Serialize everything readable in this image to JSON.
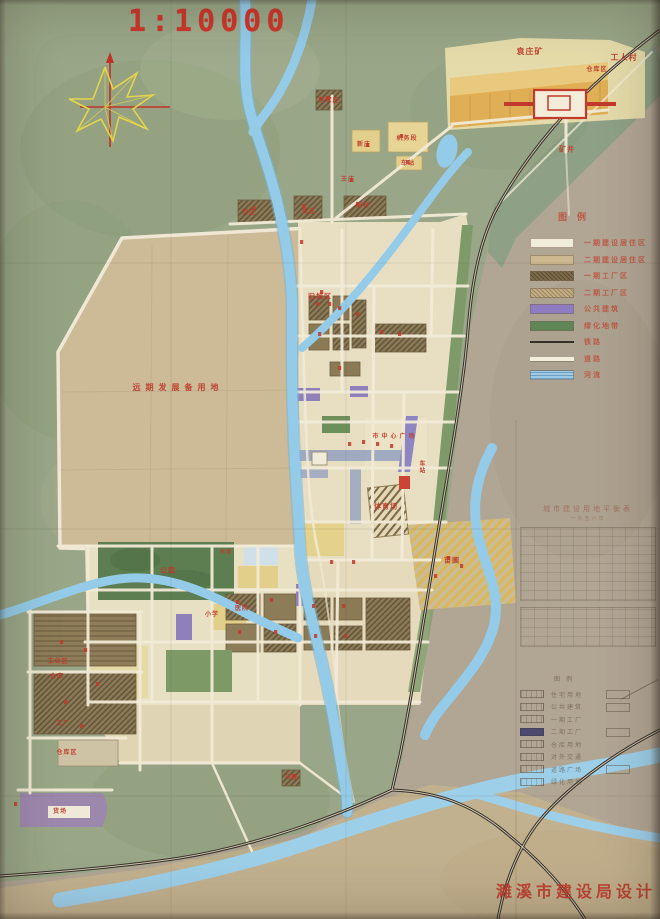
{
  "map": {
    "scale_label": "1:10000",
    "credit": "濉溪市建设局设计",
    "colors": {
      "label_red": "#bf3a2c",
      "scale_red": "#ce352b",
      "river_blue": "#8cc6e6",
      "paper_tan": "#c9b795",
      "paper_grey": "#b1a594",
      "farm_green": "#99a687",
      "block_cream": "#e9e0c4",
      "block_yellow": "#e4d18c",
      "block_brown": "#8d7c58",
      "block_purple": "#8f7fba",
      "park_green": "#5c7e50",
      "rail_black": "#35302a",
      "industrial_orange": "#dfae55"
    },
    "legend": {
      "title": "图例",
      "rows": [
        {
          "label": "一期建设居住区",
          "swatch": "cream"
        },
        {
          "label": "二期建设居住区",
          "swatch": "tan"
        },
        {
          "label": "一期工厂区",
          "swatch": "brown-hatch"
        },
        {
          "label": "二期工厂区",
          "swatch": "tan-hatch"
        },
        {
          "label": "公共建筑",
          "swatch": "purple"
        },
        {
          "label": "绿化地带",
          "swatch": "green"
        },
        {
          "label": "铁路",
          "swatch": "rail-line"
        },
        {
          "label": "道路",
          "swatch": "road"
        },
        {
          "label": "河流",
          "swatch": "river"
        }
      ]
    },
    "pencil_table": {
      "title": "城市建设用地平衡表",
      "subtitle": "一九五六年"
    },
    "pencil_legend": {
      "title": "图例",
      "rows": [
        {
          "label": "住宅用地",
          "filled": false
        },
        {
          "label": "公共建筑",
          "filled": false
        },
        {
          "label": "一期工厂",
          "filled": false
        },
        {
          "label": "二期工厂",
          "filled": true
        },
        {
          "label": "仓库用地",
          "filled": false
        },
        {
          "label": "对外交通",
          "filled": false
        },
        {
          "label": "道路广场",
          "filled": false
        },
        {
          "label": "绿化用地",
          "filled": false
        }
      ],
      "right_rows": [
        0,
        1,
        3,
        6
      ]
    },
    "labels": [
      {
        "text": "袁庄矿",
        "x": 530,
        "y": 52,
        "size": 8
      },
      {
        "text": "工人村",
        "x": 624,
        "y": 58,
        "size": 8
      },
      {
        "text": "仓库区",
        "x": 597,
        "y": 70,
        "size": 6
      },
      {
        "text": "矿井",
        "x": 567,
        "y": 150,
        "size": 7
      },
      {
        "text": "李家庄",
        "x": 329,
        "y": 101,
        "size": 6
      },
      {
        "text": "新庄",
        "x": 364,
        "y": 145,
        "size": 6
      },
      {
        "text": "机务段",
        "x": 407,
        "y": 139,
        "size": 6
      },
      {
        "text": "车站",
        "x": 408,
        "y": 164,
        "size": 6
      },
      {
        "text": "王庄",
        "x": 348,
        "y": 180,
        "size": 6
      },
      {
        "text": "刘庄",
        "x": 249,
        "y": 213,
        "size": 6
      },
      {
        "text": "张庄",
        "x": 309,
        "y": 212,
        "size": 6
      },
      {
        "text": "旧村",
        "x": 363,
        "y": 206,
        "size": 6
      },
      {
        "text": "旧城区",
        "x": 320,
        "y": 297,
        "size": 7
      },
      {
        "text": "远期发展备用地",
        "x": 178,
        "y": 388,
        "size": 8,
        "spacing": 5
      },
      {
        "text": "市中心广场",
        "x": 395,
        "y": 437,
        "size": 6,
        "spacing": 3
      },
      {
        "text": "车站",
        "x": 421,
        "y": 467,
        "size": 6,
        "vertical": true
      },
      {
        "text": "体育场",
        "x": 386,
        "y": 507,
        "size": 7
      },
      {
        "text": "苗圃",
        "x": 452,
        "y": 561,
        "size": 7
      },
      {
        "text": "公园",
        "x": 168,
        "y": 571,
        "size": 7
      },
      {
        "text": "市场",
        "x": 226,
        "y": 553,
        "size": 5
      },
      {
        "text": "小学",
        "x": 212,
        "y": 615,
        "size": 6
      },
      {
        "text": "医院",
        "x": 242,
        "y": 609,
        "size": 6
      },
      {
        "text": "工业区",
        "x": 58,
        "y": 662,
        "size": 6
      },
      {
        "text": "仓库",
        "x": 57,
        "y": 677,
        "size": 6
      },
      {
        "text": "工厂",
        "x": 63,
        "y": 724,
        "size": 6
      },
      {
        "text": "仓库区",
        "x": 67,
        "y": 753,
        "size": 6
      },
      {
        "text": "货场",
        "x": 60,
        "y": 812,
        "size": 6
      },
      {
        "text": "马庄",
        "x": 292,
        "y": 778,
        "size": 6
      }
    ],
    "building_marks": [
      [
        316,
        302
      ],
      [
        328,
        302
      ],
      [
        318,
        332
      ],
      [
        338,
        306
      ],
      [
        356,
        312
      ],
      [
        380,
        330
      ],
      [
        398,
        332
      ],
      [
        338,
        366
      ],
      [
        300,
        240
      ],
      [
        252,
        206
      ],
      [
        302,
        204
      ],
      [
        356,
        202
      ],
      [
        326,
        96
      ],
      [
        366,
        143
      ],
      [
        400,
        134
      ],
      [
        406,
        160
      ],
      [
        350,
        178
      ],
      [
        447,
        556
      ],
      [
        460,
        564
      ],
      [
        434,
        574
      ],
      [
        236,
        600
      ],
      [
        270,
        598
      ],
      [
        238,
        630
      ],
      [
        274,
        630
      ],
      [
        312,
        604
      ],
      [
        342,
        604
      ],
      [
        314,
        634
      ],
      [
        344,
        634
      ],
      [
        60,
        640
      ],
      [
        84,
        648
      ],
      [
        96,
        682
      ],
      [
        64,
        700
      ],
      [
        80,
        724
      ],
      [
        292,
        774
      ],
      [
        14,
        802
      ],
      [
        348,
        442
      ],
      [
        362,
        440
      ],
      [
        376,
        442
      ],
      [
        390,
        444
      ],
      [
        320,
        290
      ],
      [
        330,
        560
      ],
      [
        352,
        560
      ]
    ]
  }
}
